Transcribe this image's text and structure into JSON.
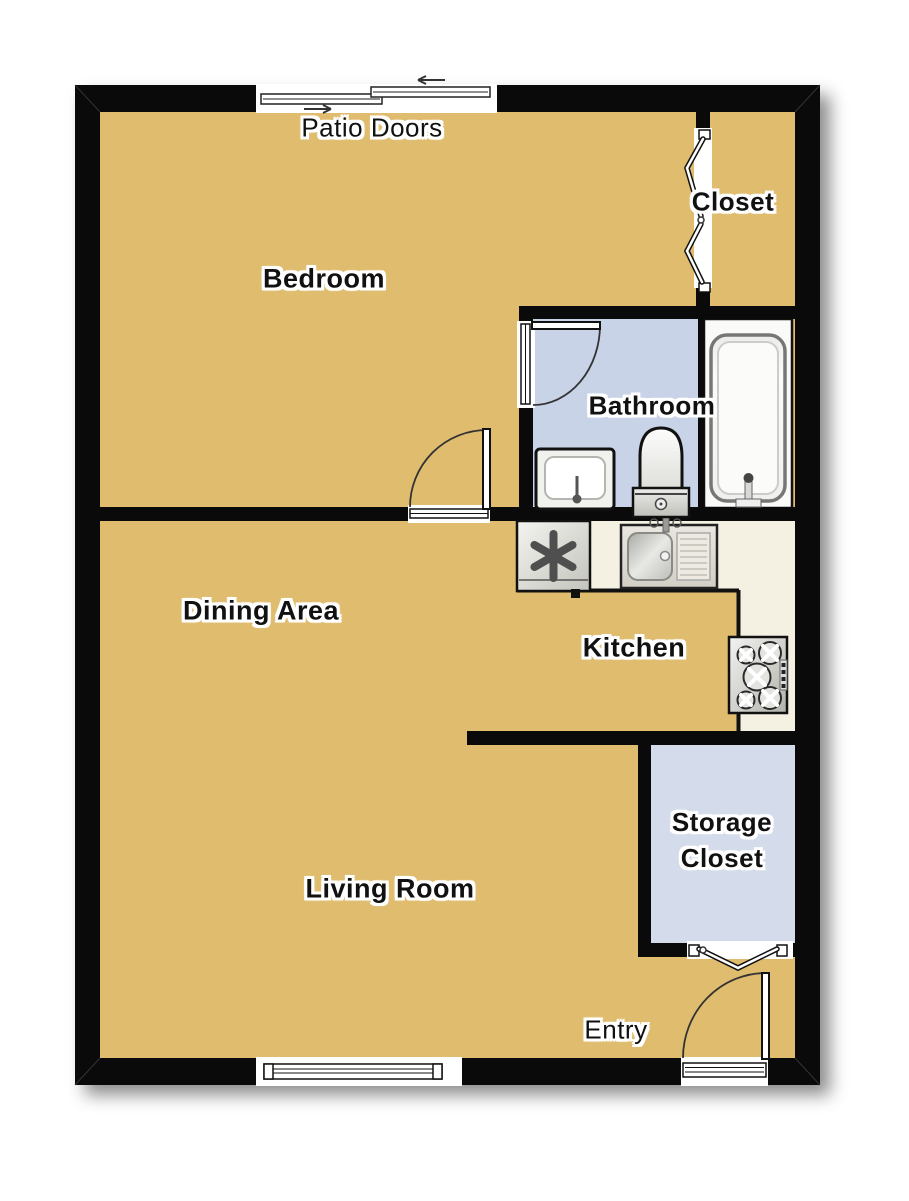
{
  "title": "One-bedroom apartment floor plan",
  "palette": {
    "wall": "#0a0a0a",
    "floor_tan": "#e0bc6e",
    "bathroom_floor_blue": "#c8d3e8",
    "storage_floor_blue": "#d4dcec",
    "counter_cream": "#f5f1e2",
    "tub_alcove_white": "#fafaf8",
    "label_text": "#111111",
    "label_halo": "#ffffff"
  },
  "labels": {
    "patio_doors": "Patio Doors",
    "bedroom": "Bedroom",
    "closet": "Closet",
    "bathroom": "Bathroom",
    "dining_area": "Dining Area",
    "kitchen": "Kitchen",
    "storage_closet_line1": "Storage",
    "storage_closet_line2": "Closet",
    "living_room": "Living Room",
    "entry": "Entry"
  },
  "fixtures": [
    "refrigerator",
    "kitchen-sink",
    "stove",
    "bathroom-sink",
    "toilet",
    "bathtub"
  ],
  "symbols": [
    "patio-sliding-door",
    "window",
    "entry-door",
    "bedroom-door",
    "bathroom-door",
    "closet-bifold-door",
    "storage-bifold-door"
  ]
}
